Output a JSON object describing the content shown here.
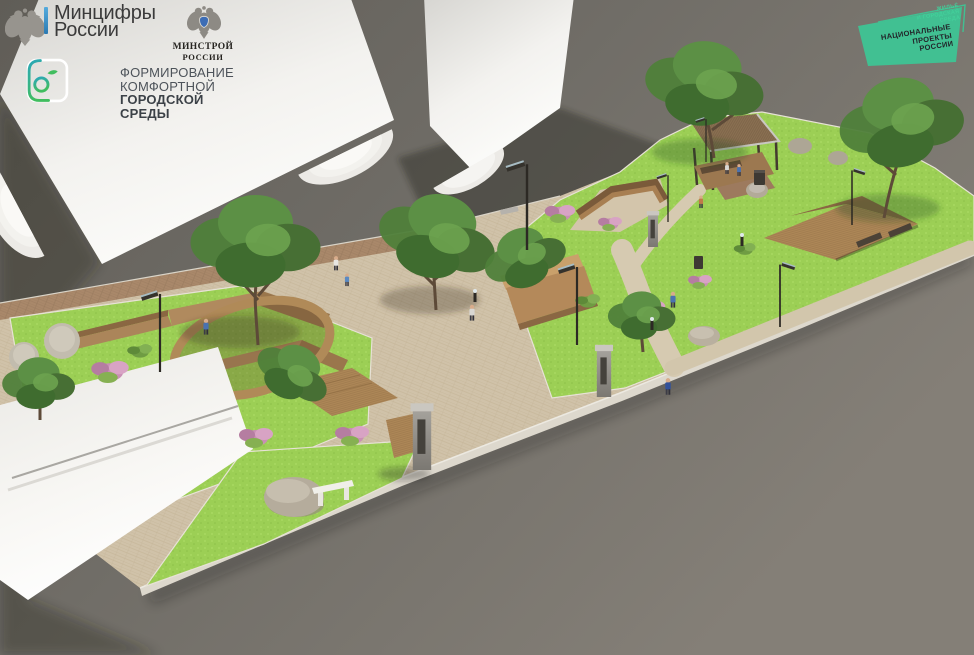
{
  "logos": {
    "mintsifry": {
      "line1": "Минцифры",
      "line2": "России"
    },
    "fkgs": {
      "line1": "ФОРМИРОВАНИЕ",
      "line2": "КОМФОРТНОЙ",
      "line3": "ГОРОДСКОЙ СРЕДЫ"
    },
    "minstroy": {
      "line1": "МИНСТРОЙ",
      "line2": "РОССИИ"
    },
    "national_projects": {
      "program_line1": "ЖИЛЬЁ",
      "program_line2": "И ГОРОДСКАЯ СРЕДА",
      "main_line1": "НАЦИОНАЛЬНЫЕ",
      "main_line2": "ПРОЕКТЫ",
      "main_line3": "РОССИИ",
      "accent_color": "#41c092"
    }
  },
  "scene": {
    "kind": "3D architectural render (aerial view)",
    "subject": "Landscape concept of a linear park strip: herringbone-paved plaza, bright lawns, trees, zigzag wooden benches, tree planter bench, pergola with wooden deck, wayfinding steles, street lamps, boulders and small human figures, set between abstract white buildings on a grey backdrop",
    "palette": {
      "backdrop": "#6e6b65",
      "building_white": "#f7f6f3",
      "pavement": "#d0c2a9",
      "brick_path": "#a9886a",
      "lawn": "#9ccf55",
      "foliage": "#4f7f3a",
      "wood": "#ad8757",
      "stone": "#b2a998"
    }
  }
}
